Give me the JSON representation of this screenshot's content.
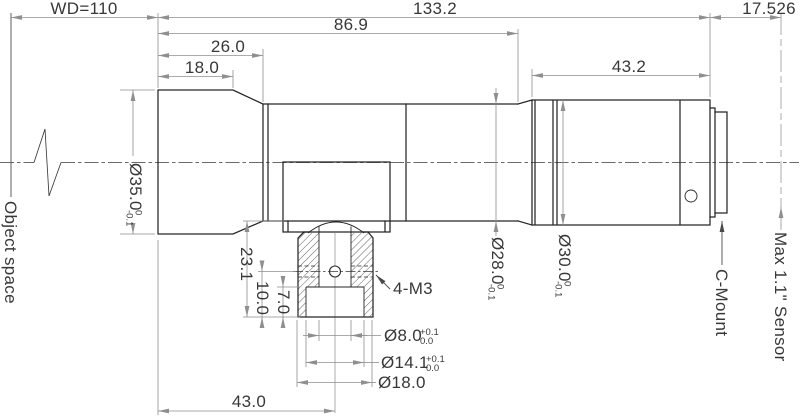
{
  "drawing": {
    "labels": {
      "object_space": "Object space",
      "c_mount": "C-Mount",
      "sensor": "Max 1.1\" Sensor",
      "screw_callout": "4-M3"
    },
    "dims": {
      "wd": "WD=110",
      "overall_length": "133.2",
      "flange_focal": "17.526",
      "front_group_length": "86.9",
      "front_section_length": "26.0",
      "front_barrel_length": "18.0",
      "rear_barrel_length": "43.2",
      "front_to_mount_center": "43.0",
      "tube_to_base": "23.1",
      "hole_to_base": "10.0",
      "cbore_depth": "7.0",
      "dia_front": {
        "v": "Ø35.0",
        "u": "0",
        "l": "-0.1"
      },
      "dia_tube": {
        "v": "Ø28.0",
        "u": "0",
        "l": "-0.1"
      },
      "dia_rear": {
        "v": "Ø30.0",
        "u": "0",
        "l": "-0.1"
      },
      "dia_slot": {
        "v": "Ø8.0",
        "u": "+0.1",
        "l": "0.0"
      },
      "dia_cbore": {
        "v": "Ø14.1",
        "u": "+0.1",
        "l": "0.0"
      },
      "dia_boss": "Ø18.0"
    },
    "colors": {
      "outline": "#262626",
      "dimension": "#8f8f8f",
      "text": "#383838",
      "background": "#ffffff"
    }
  }
}
